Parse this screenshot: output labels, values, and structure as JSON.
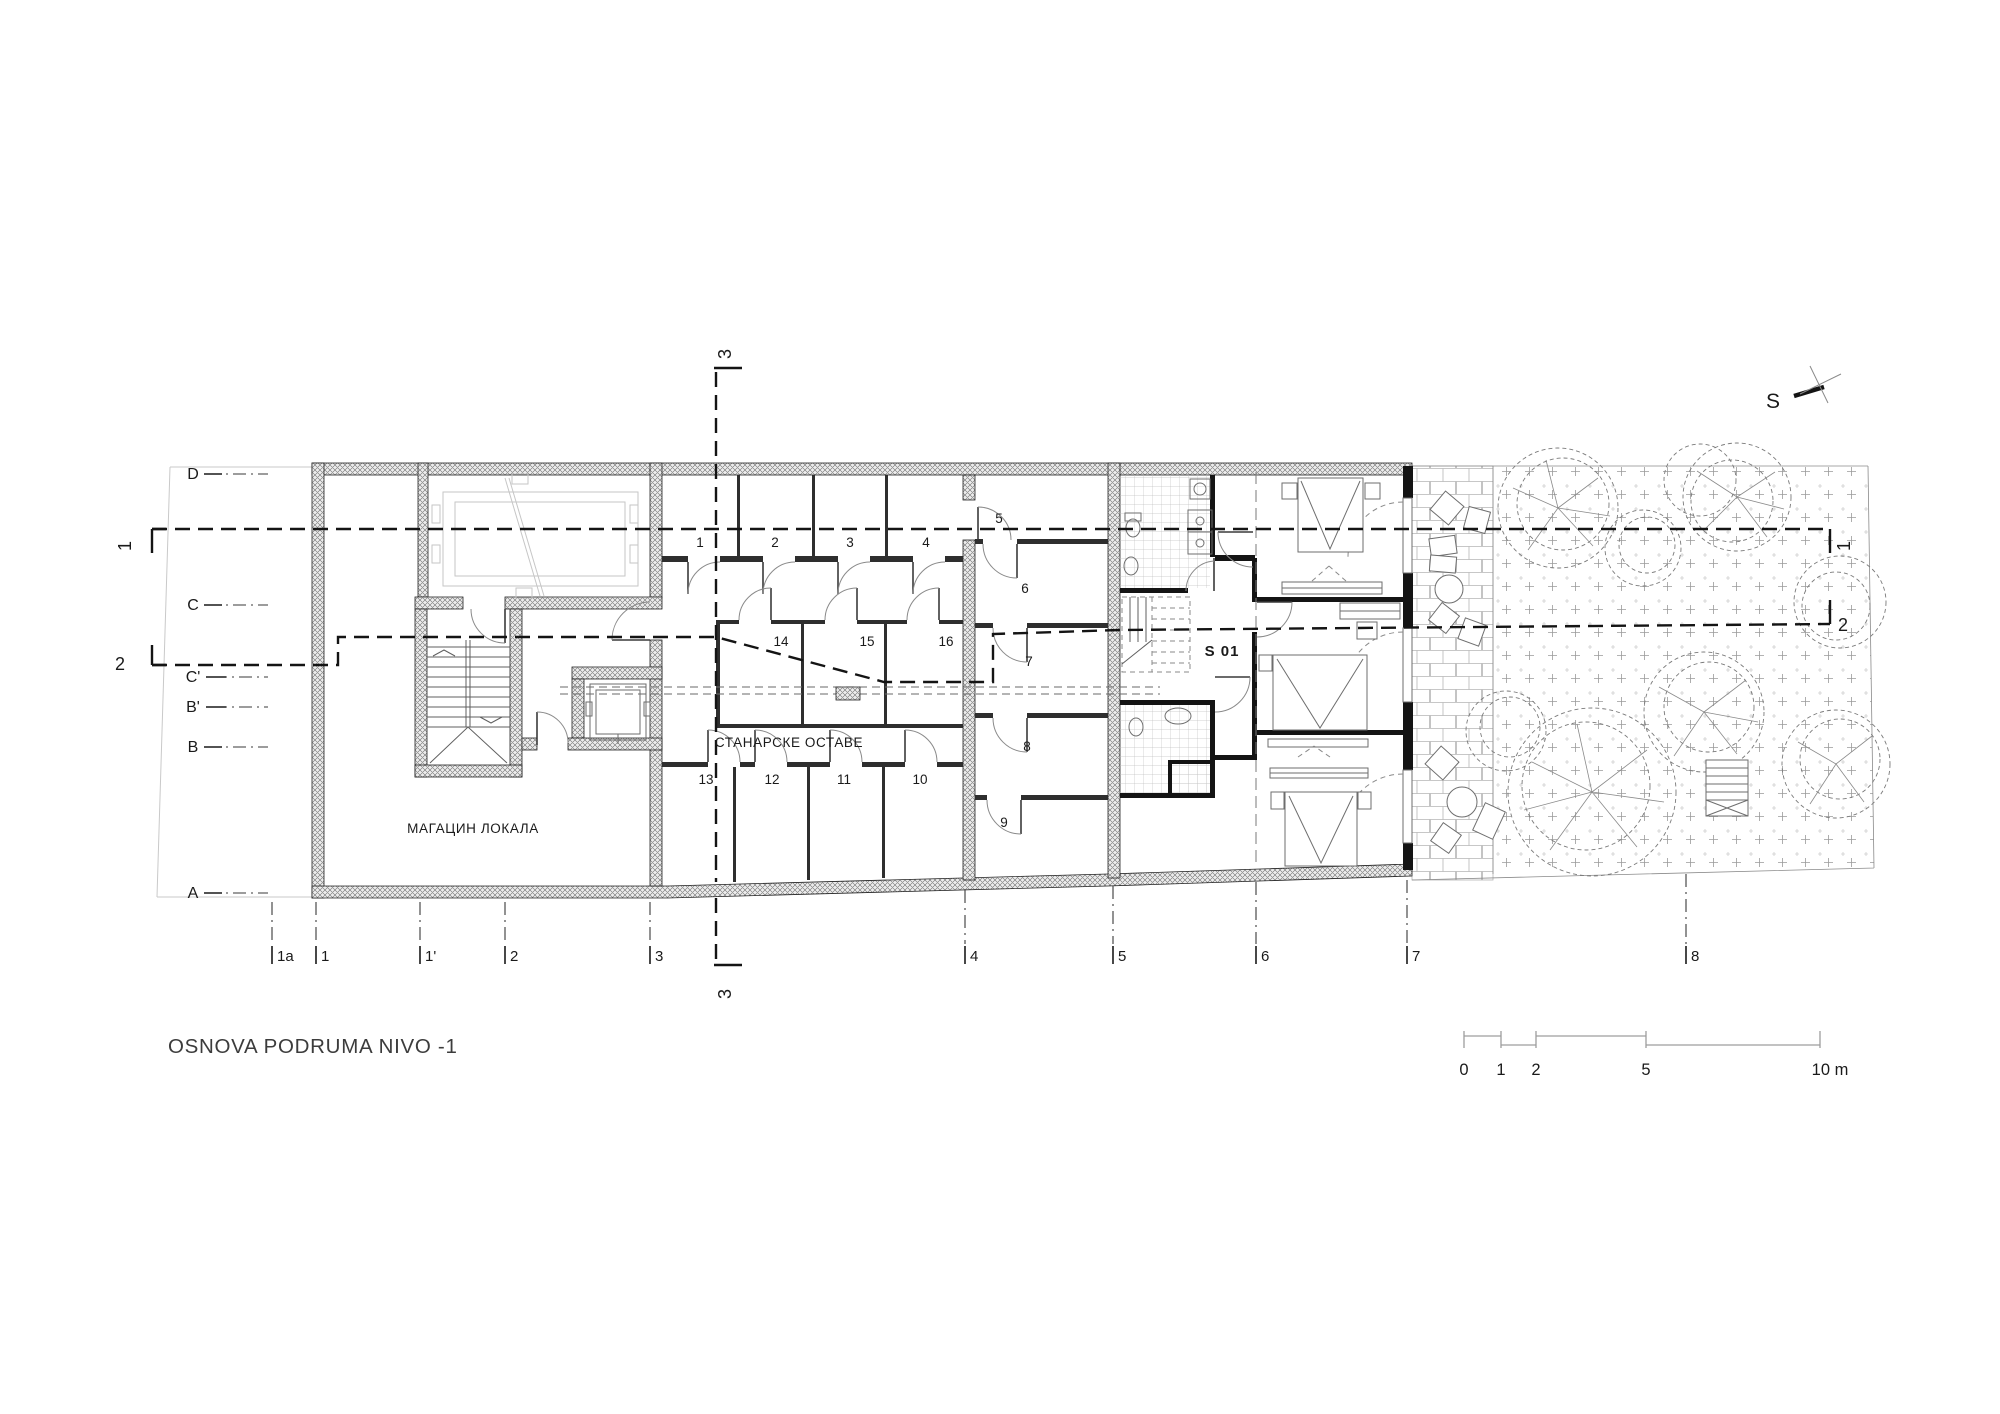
{
  "title": "OSNOVA PODRUMA NIVO -1",
  "north_label": "S",
  "labels": {
    "warehouse": "МАГАЦИН ЛОКАЛА",
    "tenant_storage": "СТАНАРСКЕ ОСТАВЕ",
    "apartment_id": "S 01"
  },
  "grid": {
    "rows": [
      "D",
      "C",
      "C'",
      "B'",
      "B",
      "A"
    ],
    "columns": [
      "1a",
      "1",
      "1'",
      "2",
      "3",
      "4",
      "5",
      "6",
      "7",
      "8"
    ]
  },
  "rooms": [
    "1",
    "2",
    "3",
    "4",
    "5",
    "6",
    "7",
    "8",
    "9",
    "10",
    "11",
    "12",
    "13",
    "14",
    "15",
    "16"
  ],
  "sections": {
    "one": "1",
    "two": "2",
    "three": "3"
  },
  "scale_bar": {
    "t0": "0",
    "t1": "1",
    "t2": "2",
    "t5": "5",
    "t10": "10 m"
  },
  "colors": {
    "wall_hatch_line": "#707070",
    "outline": "#1f1f1f",
    "dashed_section": "#141414",
    "faint_equipment": "#c6c6c6",
    "tile": "#c2c2c2",
    "text": "#1a1a1a",
    "title": "#3c3c3c"
  }
}
